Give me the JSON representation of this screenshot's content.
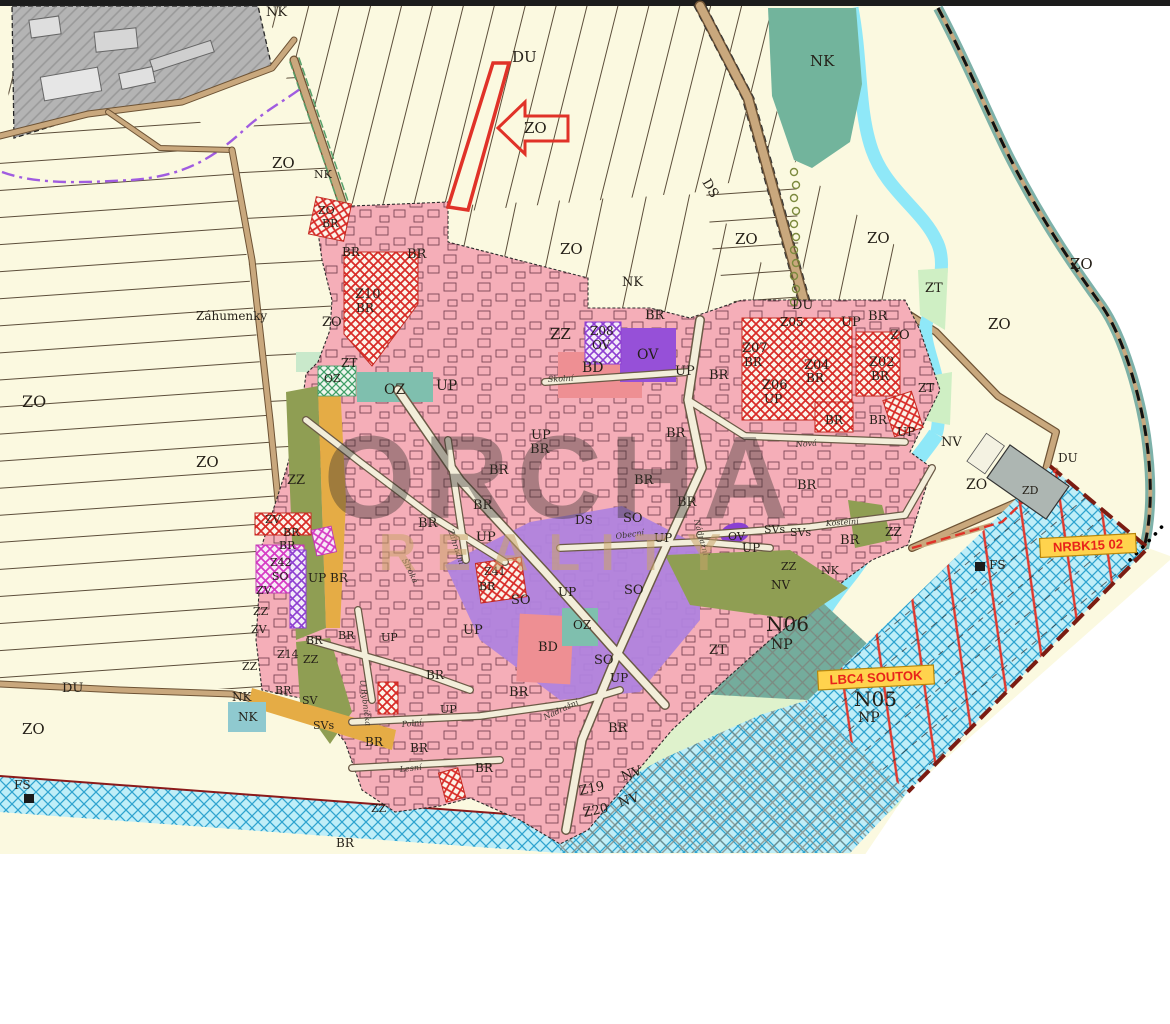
{
  "map": {
    "watermark": {
      "line1": "ORCHA",
      "line2": "REALITY"
    },
    "annotations": {
      "nrbk": "NRBK15 02",
      "lbc4": "LBC4 SOUTOK"
    },
    "zone_colors": {
      "BR_pink": "#f5aeb8",
      "BD_salmon": "#ee8f93",
      "SO_purple": "#b083dd",
      "OV_deep_purple": "#9650d8",
      "SV_orange": "#e5ac45",
      "ZZ_olive": "#8f9e53",
      "OZ_teal": "#7fbfae",
      "NK_teal": "#72b49c",
      "ZT_mint": "#cfefc4",
      "ZO_cream": "#fbf9e0",
      "water_blue": "#8fe8f8",
      "nrbk_fill": "#bfeef8",
      "dev_zone_hatch_red": "#d92b27",
      "label_box_yellow": "#ffd34d",
      "label_text_red": "#e8231a",
      "boundary_purple": "#a05ce0",
      "industrial_gray": "#b4b4b4"
    },
    "labels": [
      {
        "t": "NK",
        "x": 266,
        "y": 16,
        "s": 13
      },
      {
        "t": "DU",
        "x": 512,
        "y": 62,
        "s": 15
      },
      {
        "t": "NK",
        "x": 810,
        "y": 66,
        "s": 15
      },
      {
        "t": "ZO",
        "x": 272,
        "y": 168,
        "s": 15
      },
      {
        "t": "NK",
        "x": 314,
        "y": 178,
        "s": 11
      },
      {
        "t": "ZO",
        "x": 524,
        "y": 133,
        "s": 15
      },
      {
        "t": "DS",
        "x": 702,
        "y": 182,
        "s": 13,
        "r": 60
      },
      {
        "t": "ZO",
        "x": 318,
        "y": 214,
        "s": 11
      },
      {
        "t": "BR",
        "x": 322,
        "y": 227,
        "s": 11
      },
      {
        "t": "BR",
        "x": 342,
        "y": 256,
        "s": 12
      },
      {
        "t": "BR",
        "x": 407,
        "y": 258,
        "s": 13
      },
      {
        "t": "ZO",
        "x": 560,
        "y": 254,
        "s": 15
      },
      {
        "t": "ZO",
        "x": 735,
        "y": 244,
        "s": 15
      },
      {
        "t": "ZO",
        "x": 867,
        "y": 243,
        "s": 15
      },
      {
        "t": "NK",
        "x": 622,
        "y": 286,
        "s": 13
      },
      {
        "t": "ZO",
        "x": 1070,
        "y": 269,
        "s": 15
      },
      {
        "t": "ZO",
        "x": 988,
        "y": 329,
        "s": 15
      },
      {
        "t": "ZT",
        "x": 925,
        "y": 292,
        "s": 13
      },
      {
        "t": "Záhumenky",
        "x": 196,
        "y": 320,
        "s": 12
      },
      {
        "t": "ZO",
        "x": 322,
        "y": 326,
        "s": 13
      },
      {
        "t": "Z10",
        "x": 355,
        "y": 298,
        "s": 13
      },
      {
        "t": "BR",
        "x": 356,
        "y": 312,
        "s": 12
      },
      {
        "t": "ZO",
        "x": 22,
        "y": 407,
        "s": 16
      },
      {
        "t": "ZO",
        "x": 196,
        "y": 467,
        "s": 15
      },
      {
        "t": "ZT",
        "x": 341,
        "y": 367,
        "s": 12
      },
      {
        "t": "OZ",
        "x": 324,
        "y": 382,
        "s": 11
      },
      {
        "t": "OZ",
        "x": 384,
        "y": 394,
        "s": 14
      },
      {
        "t": "UP",
        "x": 436,
        "y": 390,
        "s": 14
      },
      {
        "t": "ZZ",
        "x": 550,
        "y": 339,
        "s": 15
      },
      {
        "t": "Z08",
        "x": 590,
        "y": 335,
        "s": 12
      },
      {
        "t": "OV",
        "x": 592,
        "y": 349,
        "s": 12
      },
      {
        "t": "OV",
        "x": 637,
        "y": 359,
        "s": 14
      },
      {
        "t": "BD",
        "x": 582,
        "y": 372,
        "s": 14
      },
      {
        "t": "BR",
        "x": 645,
        "y": 319,
        "s": 13
      },
      {
        "t": "UP",
        "x": 675,
        "y": 375,
        "s": 13
      },
      {
        "t": "BR",
        "x": 709,
        "y": 379,
        "s": 13
      },
      {
        "t": "DU",
        "x": 792,
        "y": 309,
        "s": 13
      },
      {
        "t": "Z05",
        "x": 780,
        "y": 326,
        "s": 12
      },
      {
        "t": "UP",
        "x": 841,
        "y": 326,
        "s": 13
      },
      {
        "t": "BR",
        "x": 868,
        "y": 320,
        "s": 13
      },
      {
        "t": "ZO",
        "x": 890,
        "y": 339,
        "s": 13
      },
      {
        "t": "Z07",
        "x": 742,
        "y": 352,
        "s": 13
      },
      {
        "t": "BR",
        "x": 744,
        "y": 366,
        "s": 12
      },
      {
        "t": "Z04",
        "x": 804,
        "y": 369,
        "s": 13
      },
      {
        "t": "BR",
        "x": 806,
        "y": 382,
        "s": 12
      },
      {
        "t": "Z06",
        "x": 762,
        "y": 389,
        "s": 13
      },
      {
        "t": "UP",
        "x": 764,
        "y": 403,
        "s": 12
      },
      {
        "t": "Z02",
        "x": 869,
        "y": 366,
        "s": 13
      },
      {
        "t": "BR",
        "x": 871,
        "y": 380,
        "s": 12
      },
      {
        "t": "ZT",
        "x": 918,
        "y": 392,
        "s": 12
      },
      {
        "t": "UP",
        "x": 531,
        "y": 439,
        "s": 13
      },
      {
        "t": "BR",
        "x": 530,
        "y": 453,
        "s": 13
      },
      {
        "t": "BR",
        "x": 489,
        "y": 474,
        "s": 13
      },
      {
        "t": "BR",
        "x": 473,
        "y": 509,
        "s": 13
      },
      {
        "t": "BR",
        "x": 418,
        "y": 527,
        "s": 13
      },
      {
        "t": "UP",
        "x": 476,
        "y": 541,
        "s": 13
      },
      {
        "t": "BR",
        "x": 666,
        "y": 437,
        "s": 13
      },
      {
        "t": "BR",
        "x": 634,
        "y": 484,
        "s": 13
      },
      {
        "t": "BR",
        "x": 677,
        "y": 506,
        "s": 13
      },
      {
        "t": "SO",
        "x": 623,
        "y": 522,
        "s": 13
      },
      {
        "t": "DS",
        "x": 575,
        "y": 524,
        "s": 12
      },
      {
        "t": "UP",
        "x": 654,
        "y": 542,
        "s": 12
      },
      {
        "t": "UP",
        "x": 742,
        "y": 552,
        "s": 12
      },
      {
        "t": "OV",
        "x": 728,
        "y": 540,
        "s": 11
      },
      {
        "t": "SVs",
        "x": 764,
        "y": 533,
        "s": 11
      },
      {
        "t": "SVs",
        "x": 790,
        "y": 536,
        "s": 11
      },
      {
        "t": "BR",
        "x": 797,
        "y": 489,
        "s": 13
      },
      {
        "t": "BR",
        "x": 840,
        "y": 544,
        "s": 13
      },
      {
        "t": "BR",
        "x": 825,
        "y": 424,
        "s": 12
      },
      {
        "t": "BR",
        "x": 869,
        "y": 424,
        "s": 12
      },
      {
        "t": "UP",
        "x": 897,
        "y": 436,
        "s": 12
      },
      {
        "t": "NV",
        "x": 941,
        "y": 446,
        "s": 13
      },
      {
        "t": "ZO",
        "x": 966,
        "y": 489,
        "s": 14
      },
      {
        "t": "DU",
        "x": 1058,
        "y": 462,
        "s": 12
      },
      {
        "t": "ZD",
        "x": 1022,
        "y": 494,
        "s": 11
      },
      {
        "t": "ZZ",
        "x": 885,
        "y": 536,
        "s": 12
      },
      {
        "t": "ZZ",
        "x": 781,
        "y": 570,
        "s": 11
      },
      {
        "t": "NK",
        "x": 821,
        "y": 574,
        "s": 11
      },
      {
        "t": "NV",
        "x": 771,
        "y": 589,
        "s": 12
      },
      {
        "t": "N06",
        "x": 766,
        "y": 631,
        "s": 20
      },
      {
        "t": "NP",
        "x": 771,
        "y": 649,
        "s": 14
      },
      {
        "t": "ZT",
        "x": 709,
        "y": 654,
        "s": 13
      },
      {
        "t": "N05",
        "x": 854,
        "y": 706,
        "s": 20
      },
      {
        "t": "NP",
        "x": 858,
        "y": 722,
        "s": 14
      },
      {
        "t": "FS",
        "x": 989,
        "y": 569,
        "s": 12
      },
      {
        "t": "FS",
        "x": 14,
        "y": 789,
        "s": 12
      },
      {
        "t": "ZO",
        "x": 22,
        "y": 734,
        "s": 15
      },
      {
        "t": "DU",
        "x": 62,
        "y": 692,
        "s": 13
      },
      {
        "t": "NK",
        "x": 232,
        "y": 701,
        "s": 12
      },
      {
        "t": "NK",
        "x": 238,
        "y": 721,
        "s": 12
      },
      {
        "t": "ZZ",
        "x": 287,
        "y": 484,
        "s": 13
      },
      {
        "t": "ZV",
        "x": 265,
        "y": 523,
        "s": 11
      },
      {
        "t": "BR",
        "x": 283,
        "y": 536,
        "s": 11
      },
      {
        "t": "BR",
        "x": 279,
        "y": 549,
        "s": 11
      },
      {
        "t": "Z42",
        "x": 270,
        "y": 566,
        "s": 11
      },
      {
        "t": "SO",
        "x": 272,
        "y": 580,
        "s": 11
      },
      {
        "t": "ZV",
        "x": 256,
        "y": 594,
        "s": 11
      },
      {
        "t": "ZZ",
        "x": 253,
        "y": 615,
        "s": 11
      },
      {
        "t": "ZV",
        "x": 251,
        "y": 633,
        "s": 11
      },
      {
        "t": "Z14",
        "x": 277,
        "y": 658,
        "s": 11
      },
      {
        "t": "ZZ",
        "x": 303,
        "y": 663,
        "s": 11
      },
      {
        "t": "ZZ",
        "x": 242,
        "y": 670,
        "s": 11
      },
      {
        "t": "UP",
        "x": 308,
        "y": 582,
        "s": 12
      },
      {
        "t": "BR",
        "x": 330,
        "y": 582,
        "s": 12
      },
      {
        "t": "BR",
        "x": 275,
        "y": 694,
        "s": 11
      },
      {
        "t": "SV",
        "x": 302,
        "y": 704,
        "s": 11
      },
      {
        "t": "SVs",
        "x": 313,
        "y": 729,
        "s": 11
      },
      {
        "t": "BR",
        "x": 306,
        "y": 644,
        "s": 11
      },
      {
        "t": "BR",
        "x": 338,
        "y": 639,
        "s": 11
      },
      {
        "t": "UP",
        "x": 381,
        "y": 641,
        "s": 11
      },
      {
        "t": "BR",
        "x": 365,
        "y": 746,
        "s": 12
      },
      {
        "t": "BR",
        "x": 410,
        "y": 752,
        "s": 12
      },
      {
        "t": "BR",
        "x": 475,
        "y": 772,
        "s": 12
      },
      {
        "t": "BR",
        "x": 509,
        "y": 696,
        "s": 13
      },
      {
        "t": "BR",
        "x": 608,
        "y": 732,
        "s": 13
      },
      {
        "t": "BR",
        "x": 336,
        "y": 847,
        "s": 12
      },
      {
        "t": "ZZ",
        "x": 371,
        "y": 812,
        "s": 11
      },
      {
        "t": "Z41",
        "x": 484,
        "y": 575,
        "s": 11
      },
      {
        "t": "BR",
        "x": 479,
        "y": 590,
        "s": 11
      },
      {
        "t": "SO",
        "x": 511,
        "y": 604,
        "s": 13
      },
      {
        "t": "SO",
        "x": 624,
        "y": 594,
        "s": 13
      },
      {
        "t": "SO",
        "x": 594,
        "y": 664,
        "s": 13
      },
      {
        "t": "UP",
        "x": 558,
        "y": 596,
        "s": 12
      },
      {
        "t": "OZ",
        "x": 573,
        "y": 629,
        "s": 12
      },
      {
        "t": "BD",
        "x": 538,
        "y": 651,
        "s": 13
      },
      {
        "t": "UP",
        "x": 610,
        "y": 682,
        "s": 12
      },
      {
        "t": "UP",
        "x": 463,
        "y": 634,
        "s": 13
      },
      {
        "t": "Z19",
        "x": 580,
        "y": 795,
        "s": 13,
        "r": -12
      },
      {
        "t": "NV",
        "x": 623,
        "y": 781,
        "s": 13,
        "r": -20
      },
      {
        "t": "Z20",
        "x": 584,
        "y": 817,
        "s": 13,
        "r": -12
      },
      {
        "t": "NV",
        "x": 620,
        "y": 807,
        "s": 13,
        "r": -18
      },
      {
        "t": "BR",
        "x": 426,
        "y": 679,
        "s": 12
      },
      {
        "t": "UP",
        "x": 440,
        "y": 713,
        "s": 11
      }
    ],
    "street_labels": [
      {
        "t": "Školní",
        "x": 548,
        "y": 382,
        "r": -3
      },
      {
        "t": "Nová",
        "x": 796,
        "y": 447,
        "r": -4
      },
      {
        "t": "Kostelní",
        "x": 826,
        "y": 526,
        "r": -4
      },
      {
        "t": "Obecní",
        "x": 616,
        "y": 539,
        "r": -8
      },
      {
        "t": "Nádražní",
        "x": 694,
        "y": 520,
        "r": 75
      },
      {
        "t": "Nádražní",
        "x": 545,
        "y": 720,
        "r": -25
      },
      {
        "t": "Zahradní",
        "x": 448,
        "y": 530,
        "r": 72
      },
      {
        "t": "Široká",
        "x": 402,
        "y": 560,
        "r": 64
      },
      {
        "t": "Polní",
        "x": 402,
        "y": 727,
        "r": -6
      },
      {
        "t": "Lesní",
        "x": 400,
        "y": 772,
        "r": -6
      },
      {
        "t": "U Rybníčka",
        "x": 360,
        "y": 680,
        "r": 83
      }
    ]
  }
}
